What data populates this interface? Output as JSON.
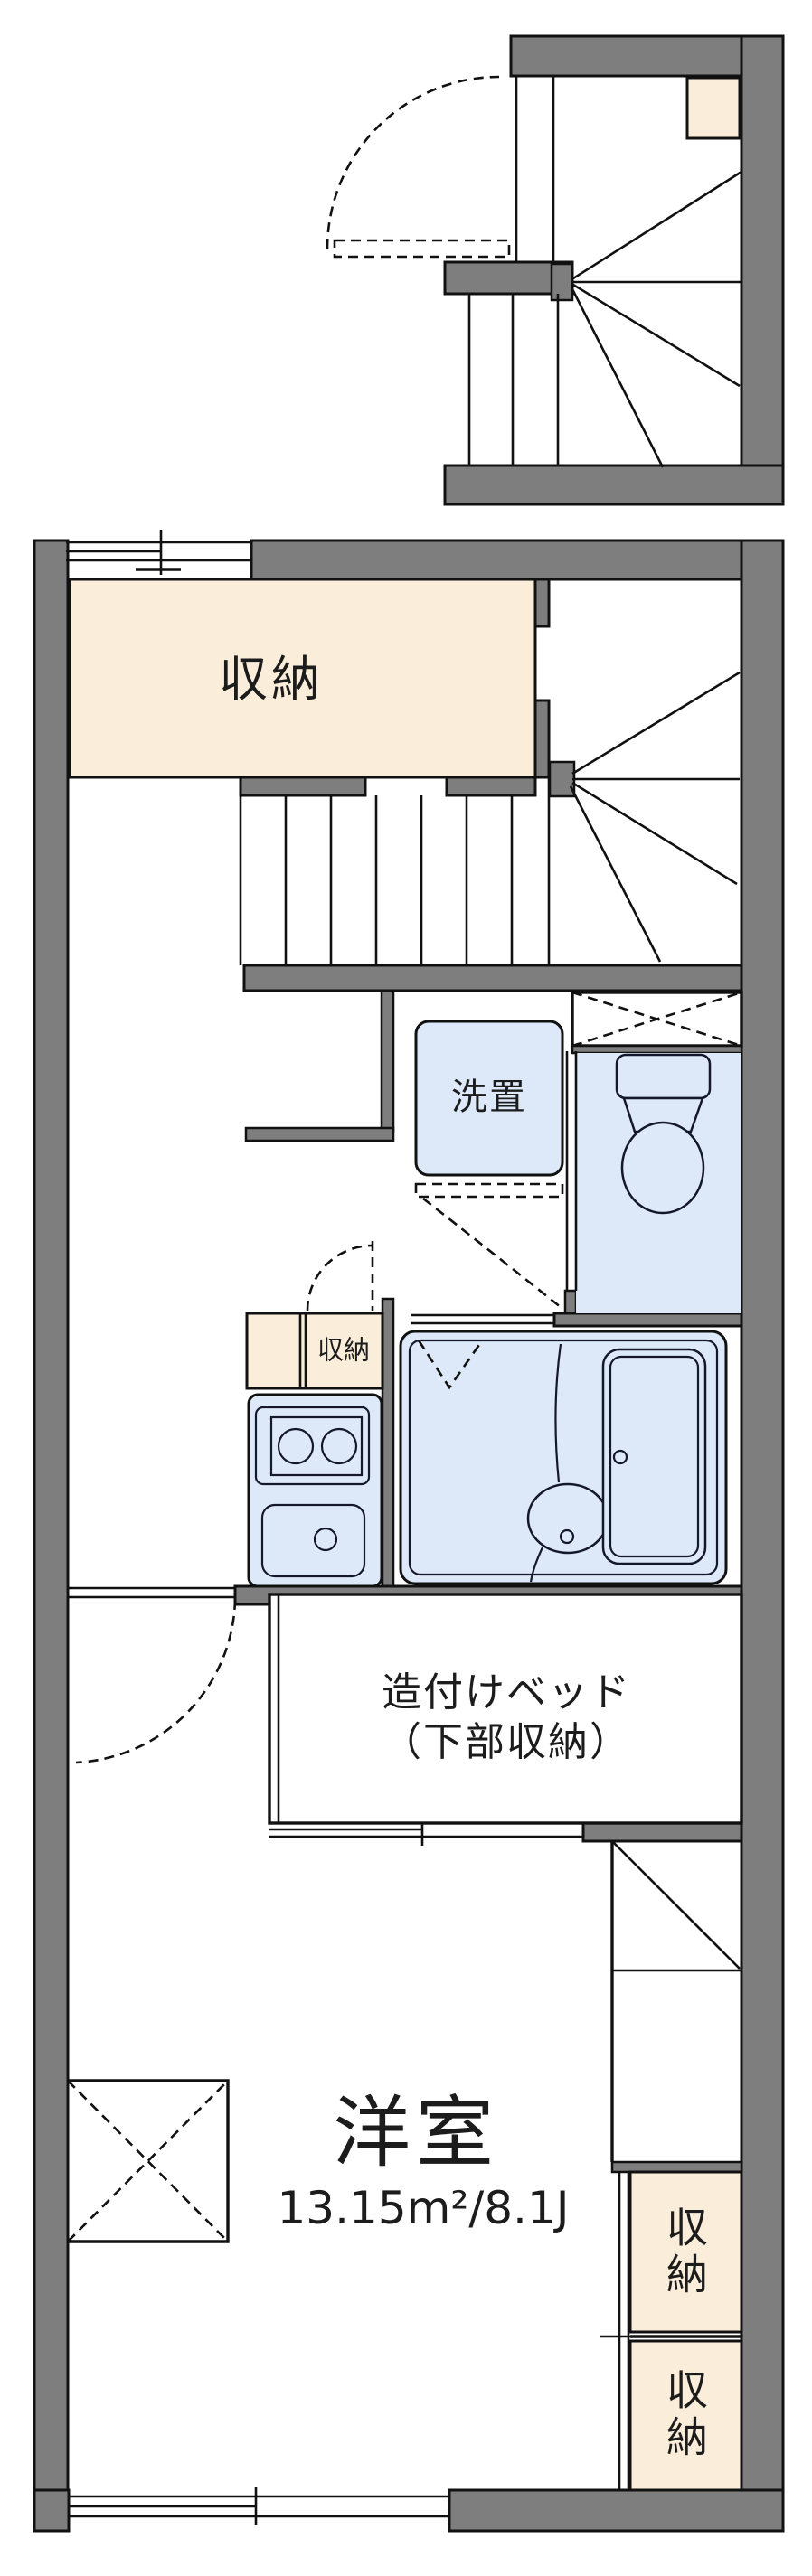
{
  "document": {
    "kind": "japanese-apartment-floor-plan"
  },
  "colors": {
    "background": "#ffffff",
    "wall_gray": "#7e7e7e",
    "outline_black": "#111111",
    "storage_cream": "#faeeda",
    "wet_area_blue": "#dde9f8"
  },
  "labels": {
    "upper_storage": "収納",
    "washer_space": "洗置",
    "kitchen_storage": "収納",
    "bed_line1": "造付けベッド",
    "bed_line2": "（下部収納）",
    "room_name": "洋室",
    "room_area": "13.15m²/8.1J",
    "closet_top": "収納",
    "closet_bottom": "収納"
  },
  "room": {
    "name": "洋室",
    "area_m2": "13.15",
    "area_jo": "8.1"
  }
}
